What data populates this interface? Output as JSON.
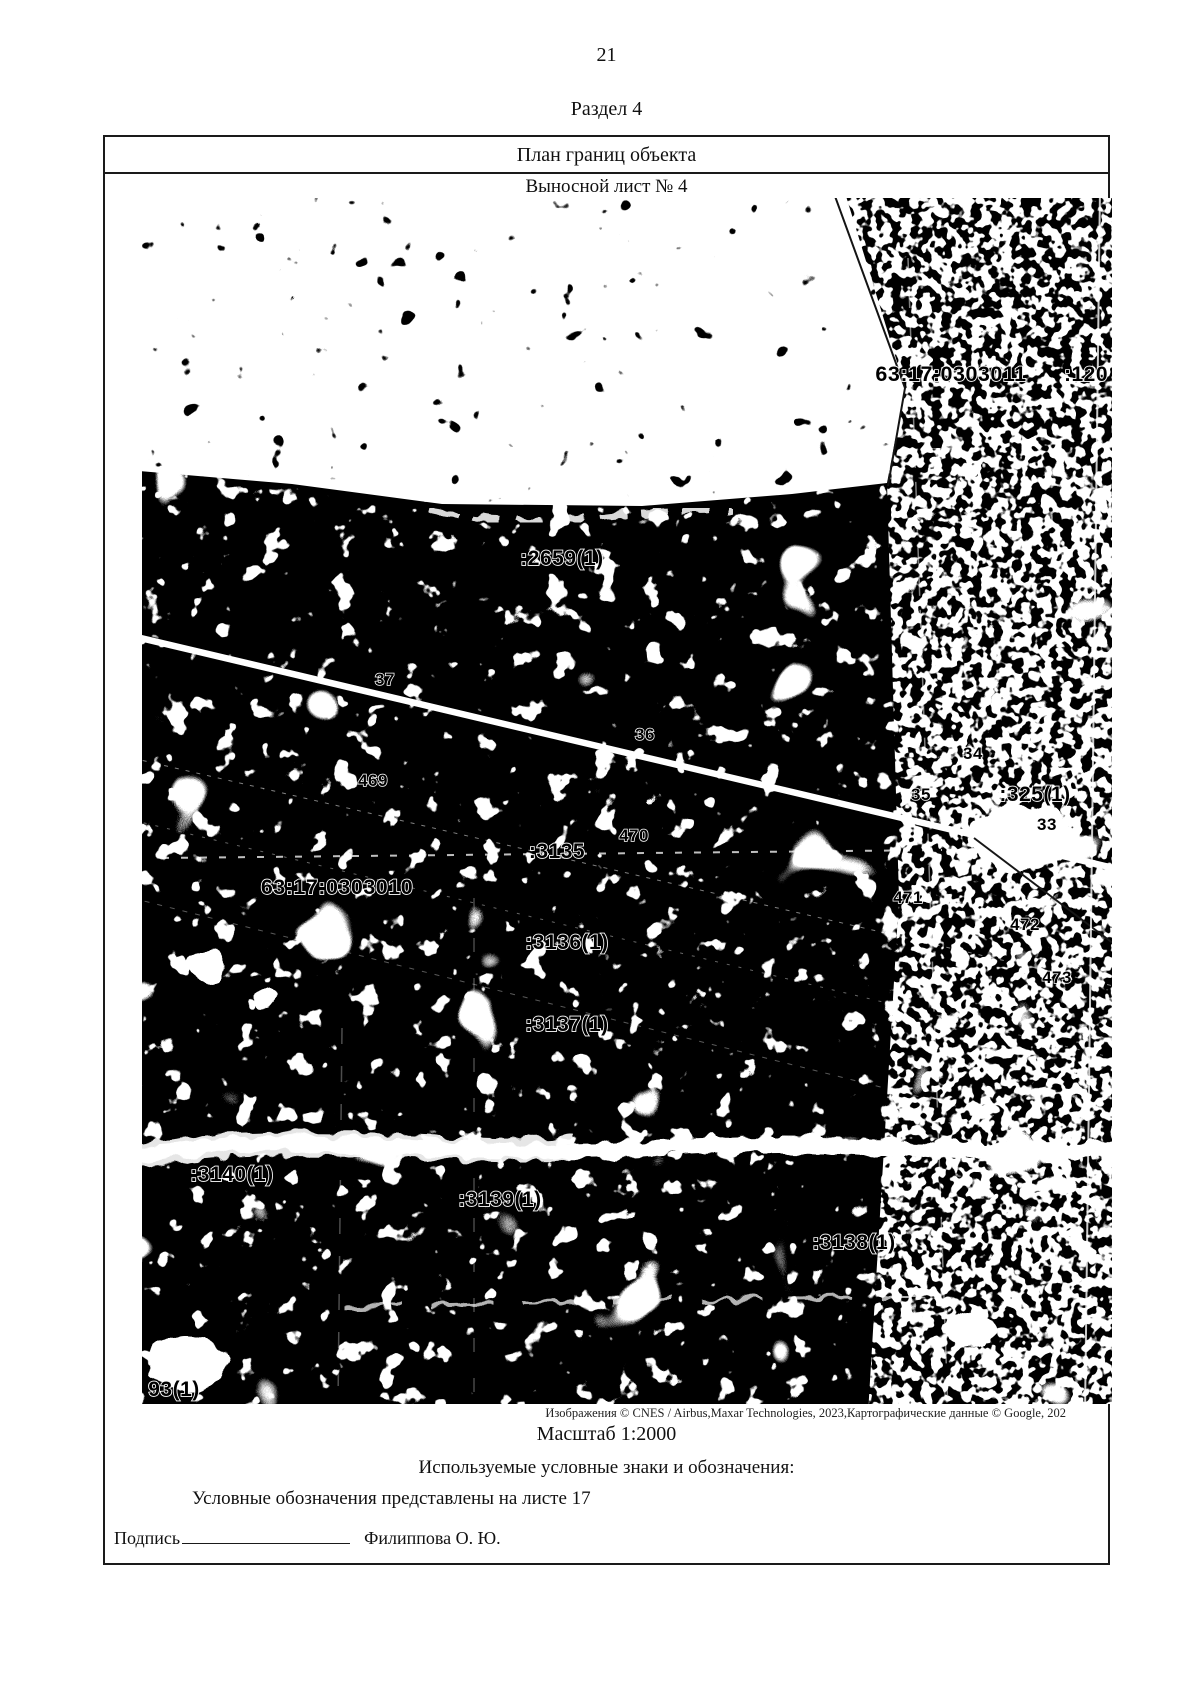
{
  "page": {
    "number": "21",
    "section": "Раздел 4"
  },
  "table": {
    "title": "План границ объекта",
    "subtitle": "Выносной лист № 4"
  },
  "map": {
    "attribution": "Изображения © CNES / Airbus,Maxar Technologies, 2023,Картографические данные © Google, 202",
    "scale": "Масштаб 1:2000",
    "labels": [
      "63:17:0303011",
      ":120",
      ":2659(1)",
      "37",
      "36",
      "469",
      "470",
      ":3135",
      "34",
      "35",
      ":325(1)",
      "33",
      "63:17:0303010",
      "471",
      "472",
      "473",
      ":3136(1)",
      ":3137(1)",
      ":3140(1)",
      ":3139(1)",
      ":3138(1)",
      "93(1)"
    ]
  },
  "legend": {
    "heading": "Используемые условные знаки и обозначения:",
    "note": "Условные обозначения представлены на листе 17"
  },
  "signature": {
    "label": "Подпись",
    "name": "Филиппова О. Ю."
  },
  "colors": {
    "map_background": "#000000",
    "map_foreground": "#ffffff",
    "border": "#1a1a1a"
  }
}
